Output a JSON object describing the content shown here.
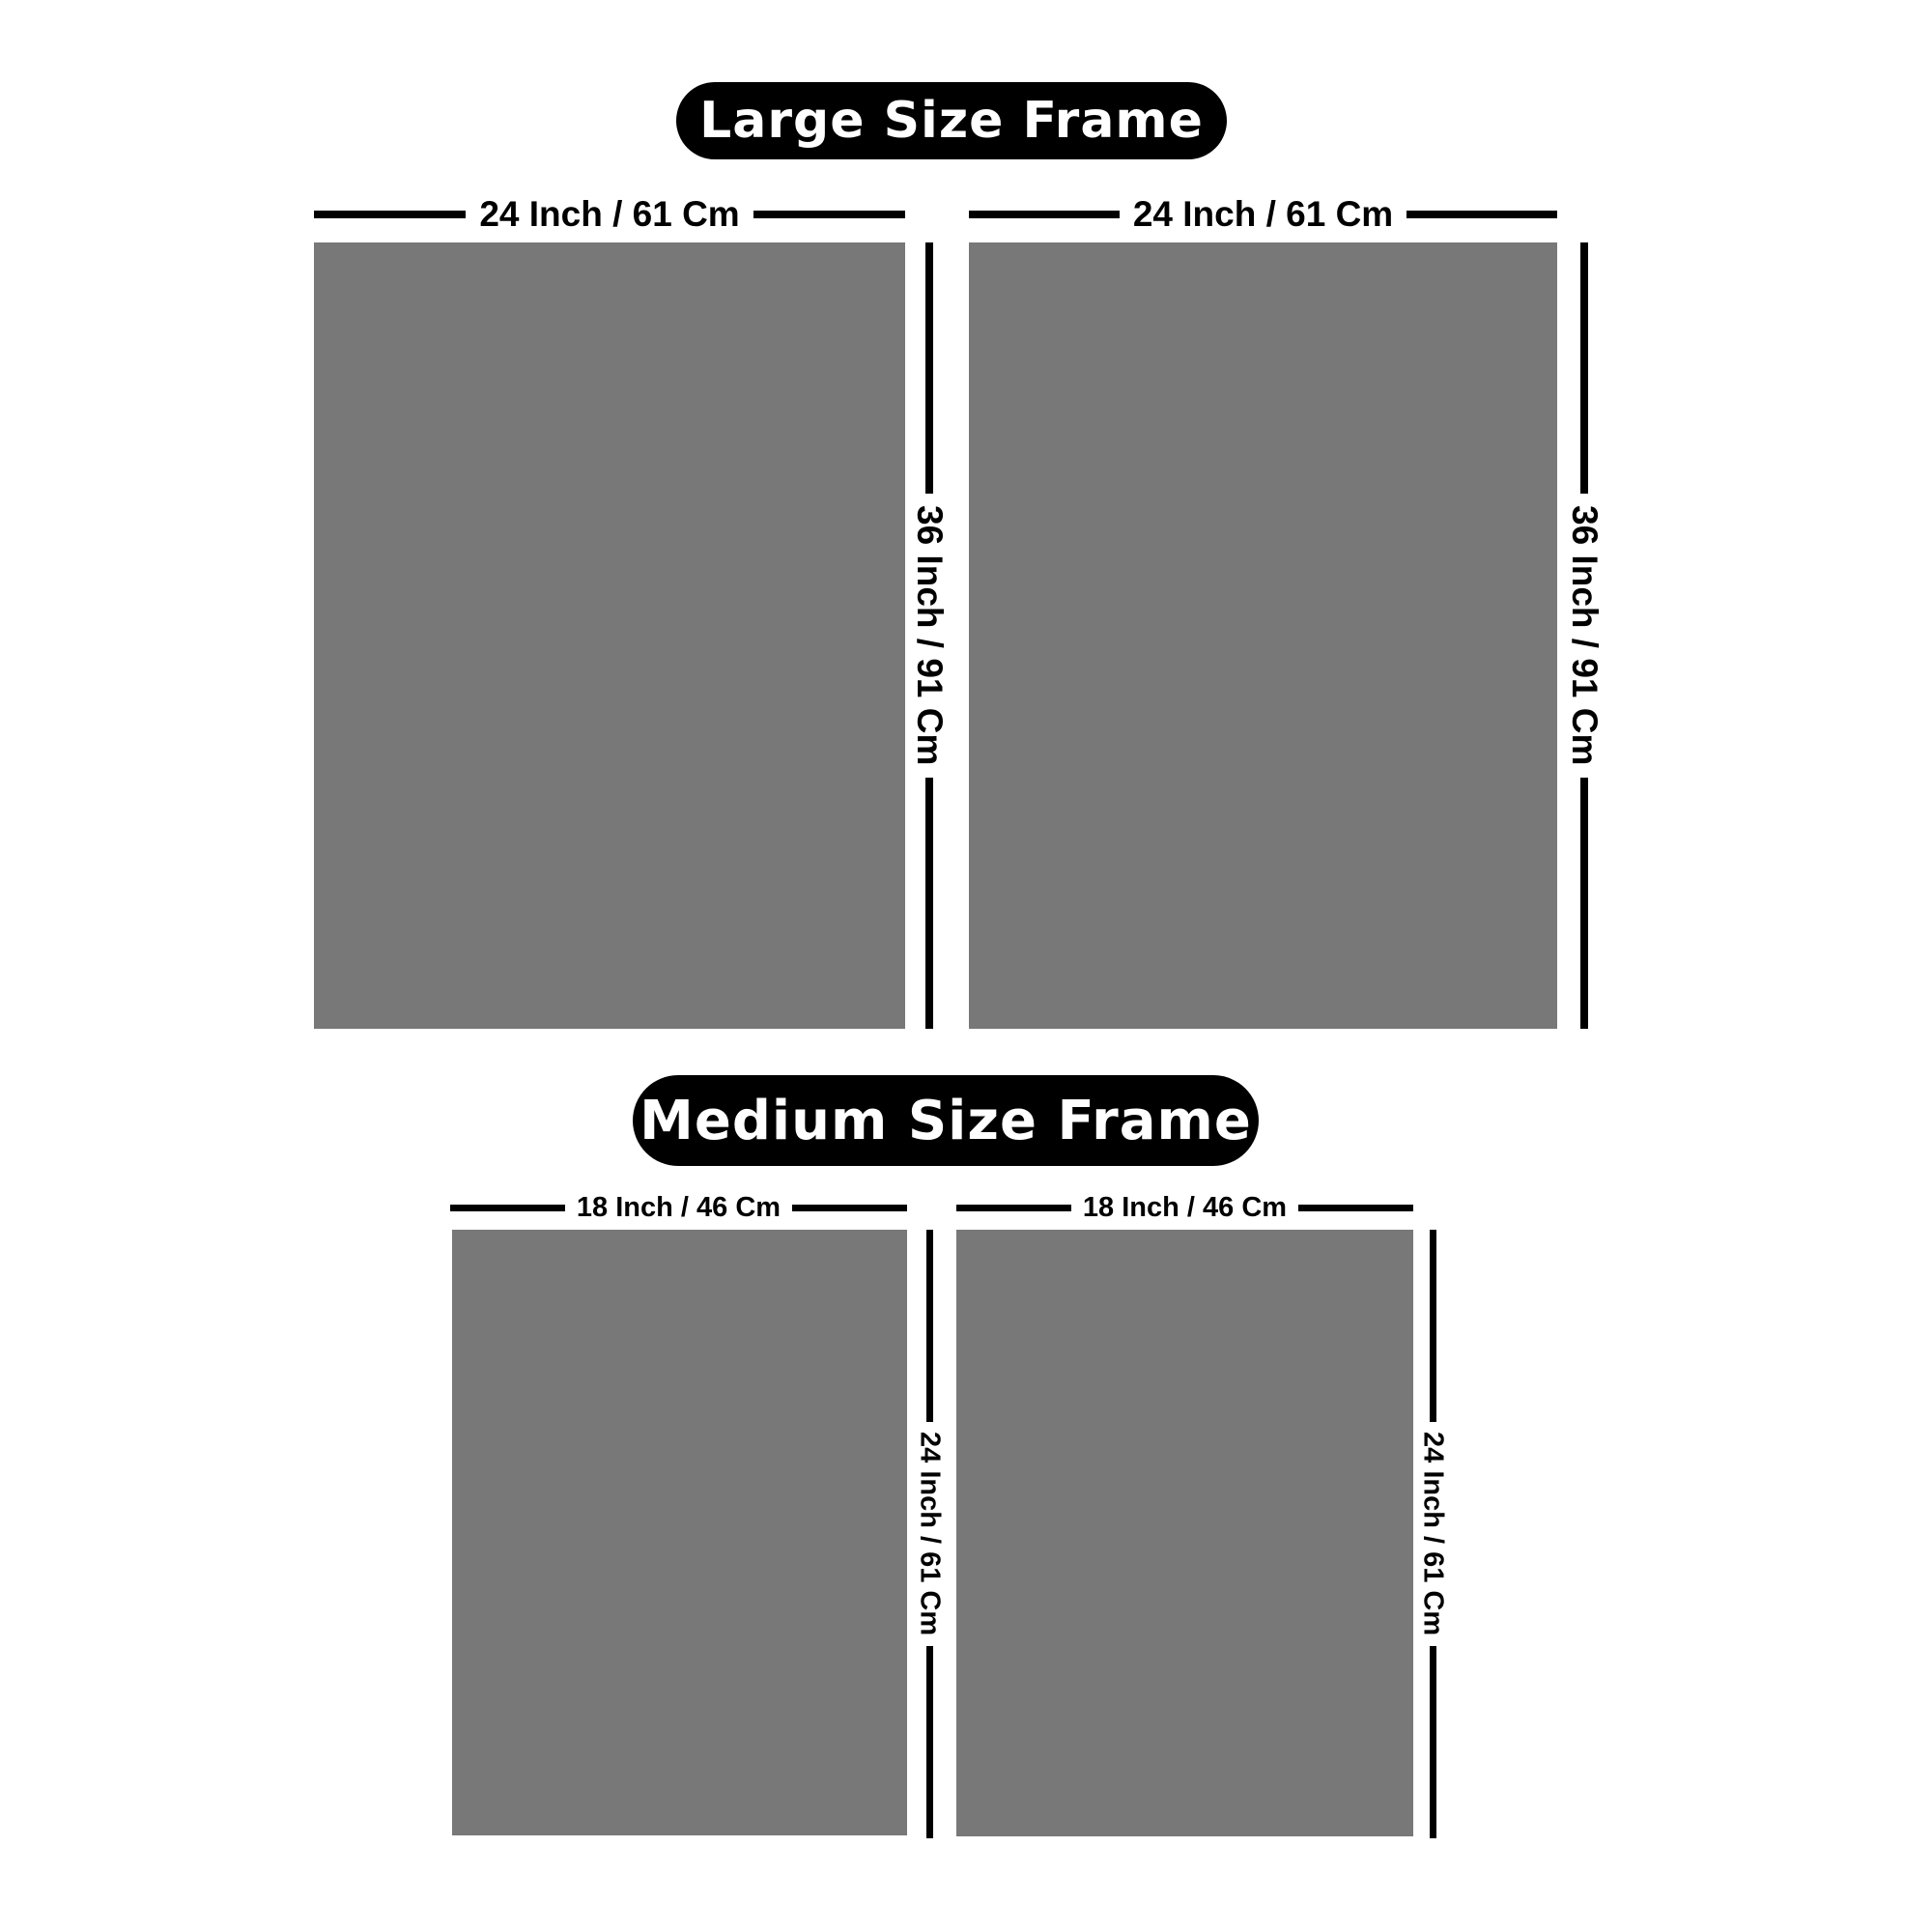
{
  "colors": {
    "background": "#ffffff",
    "frame_fill": "#787878",
    "dimension_line": "#000000",
    "pill_background": "#000000",
    "pill_text": "#ffffff"
  },
  "sections": [
    {
      "title": "Large Size Frame",
      "frames": [
        {
          "width_label": "24 Inch / 61 Cm",
          "height_label": "36 Inch / 91 Cm"
        },
        {
          "width_label": "24 Inch / 61 Cm",
          "height_label": "36 Inch / 91 Cm"
        }
      ]
    },
    {
      "title": "Medium Size Frame",
      "frames": [
        {
          "width_label": "18 Inch / 46 Cm",
          "height_label": "24 Inch / 61 Cm"
        },
        {
          "width_label": "18 Inch / 46 Cm",
          "height_label": "24 Inch / 61 Cm"
        }
      ]
    }
  ]
}
